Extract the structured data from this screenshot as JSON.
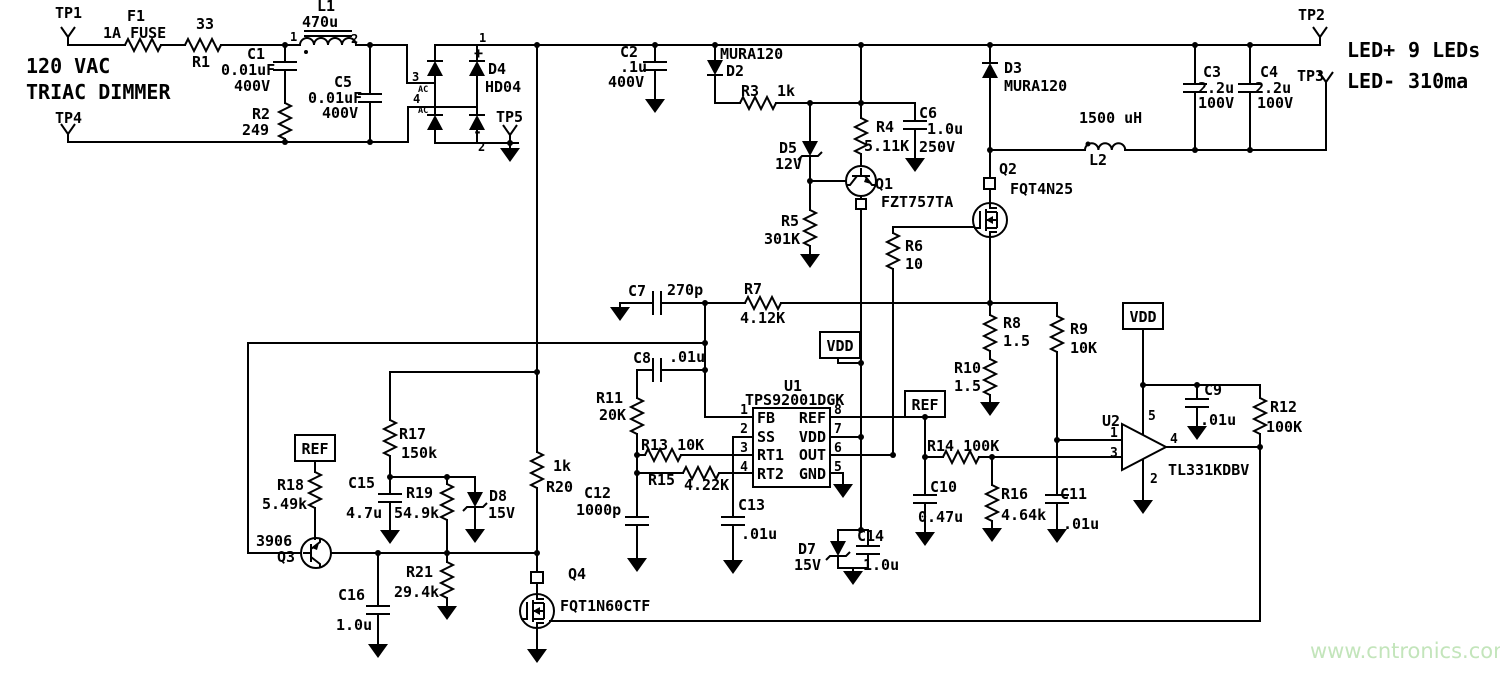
{
  "input": {
    "tp1": "TP1",
    "tp4": "TP4",
    "source_line1": "120 VAC",
    "source_line2": "TRIAC DIMMER",
    "f1_ref": "F1",
    "f1_val": "1A FUSE",
    "r1_ref": "R1",
    "r1_val": "33",
    "c1_ref": "C1",
    "c1_val": "0.01uF",
    "c1_volt": "400V",
    "r2_ref": "R2",
    "r2_val": "249",
    "l1_ref": "L1",
    "l1_val": "470u",
    "l1_pin1": "1",
    "l1_pin2": "2",
    "c5_ref": "C5",
    "c5_val": "0.01uF",
    "c5_volt": "400V"
  },
  "bridge": {
    "ref": "D4",
    "part": "HD04",
    "pin1": "1",
    "pin2": "2",
    "pin3": "3",
    "pin4": "4",
    "ac_a": "AC",
    "ac_b": "AC",
    "plus": "+",
    "minus": "-",
    "tp5": "TP5"
  },
  "bus": {
    "c2_ref": "C2",
    "c2_val": ".1u",
    "c2_volt": "400V",
    "d2_part": "MURA120",
    "d2_ref": "D2",
    "r3_ref": "R3",
    "r3_val": "1k",
    "d5_ref": "D5",
    "d5_val": "12V",
    "r4_ref": "R4",
    "r4_val": "5.11K",
    "c6_ref": "C6",
    "c6_val": "1.0u",
    "c6_volt": "250V",
    "q1_ref": "Q1",
    "q1_part": "FZT757TA",
    "r5_ref": "R5",
    "r5_val": "301K",
    "r6_ref": "R6",
    "r6_val": "10"
  },
  "output": {
    "d3_ref": "D3",
    "d3_part": "MURA120",
    "q2_ref": "Q2",
    "q2_part": "FQT4N25",
    "l2_val": "1500 uH",
    "l2_ref": "L2",
    "c3_ref": "C3",
    "c3_val": "2.2u",
    "c3_volt": "100V",
    "c4_ref": "C4",
    "c4_val": "2.2u",
    "c4_volt": "100V",
    "tp2": "TP2",
    "tp3": "TP3",
    "led_plus": "LED+",
    "led_count": "9 LEDs",
    "led_minus": "LED-",
    "led_current": "310ma",
    "r8_ref": "R8",
    "r8_val": "1.5",
    "r10_ref": "R10",
    "r10_val": "1.5",
    "r9_ref": "R9",
    "r9_val": "10K"
  },
  "comp": {
    "c7_ref": "C7",
    "c7_val": "270p",
    "r7_ref": "R7",
    "r7_val": "4.12K",
    "c8_ref": "C8",
    "c8_val": ".01u",
    "r11_ref": "R11",
    "r11_val": "20K",
    "r13_label": "R13 10K",
    "r15_ref": "R15",
    "r15_val": "4.22K",
    "c12_ref": "C12",
    "c12_val": "1000p",
    "c13_ref": "C13",
    "c13_val": ".01u"
  },
  "u1": {
    "ref": "U1",
    "part": "TPS92001DGK",
    "pin_fb": "FB",
    "pin_ss": "SS",
    "pin_rt1": "RT1",
    "pin_rt2": "RT2",
    "pin_ref": "REF",
    "pin_vdd": "VDD",
    "pin_out": "OUT",
    "pin_gnd": "GND",
    "n1": "1",
    "n2": "2",
    "n3": "3",
    "n4": "4",
    "n5": "5",
    "n6": "6",
    "n7": "7",
    "n8": "8"
  },
  "nets": {
    "vdd1": "VDD",
    "vdd2": "VDD",
    "ref1": "REF",
    "ref2": "REF"
  },
  "vdd_rail": {
    "c14_ref": "C14",
    "c14_val": "1.0u",
    "d7_ref": "D7",
    "d7_val": "15V"
  },
  "ref_div": {
    "r14_label": "R14 100K",
    "c10_ref": "C10",
    "c10_val": "0.47u",
    "r16_ref": "R16",
    "r16_val": "4.64k",
    "c11_ref": "C11",
    "c11_val": ".01u"
  },
  "u2": {
    "ref": "U2",
    "part": "TL331KDBV",
    "n1": "1",
    "n2": "2",
    "n3": "3",
    "n4": "4",
    "n5": "5",
    "c9_ref": "C9",
    "c9_val": ".01u",
    "r12_ref": "R12",
    "r12_val": "100K"
  },
  "bleeder": {
    "r20_val": "1k",
    "r20_ref": "R20",
    "q4_ref": "Q4",
    "q4_part": "FQT1N60CTF",
    "r17_ref": "R17",
    "r17_val": "150k",
    "r18_ref": "R18",
    "r18_val": "5.49k",
    "c15_ref": "C15",
    "c15_val": "4.7u",
    "r19_ref": "R19",
    "r19_val": "54.9k",
    "d8_ref": "D8",
    "d8_val": "15V",
    "q3_part": "3906",
    "q3_ref": "Q3",
    "r21_ref": "R21",
    "r21_val": "29.4k",
    "c16_ref": "C16",
    "c16_val": "1.0u"
  },
  "watermark": "www.cntronics.com"
}
